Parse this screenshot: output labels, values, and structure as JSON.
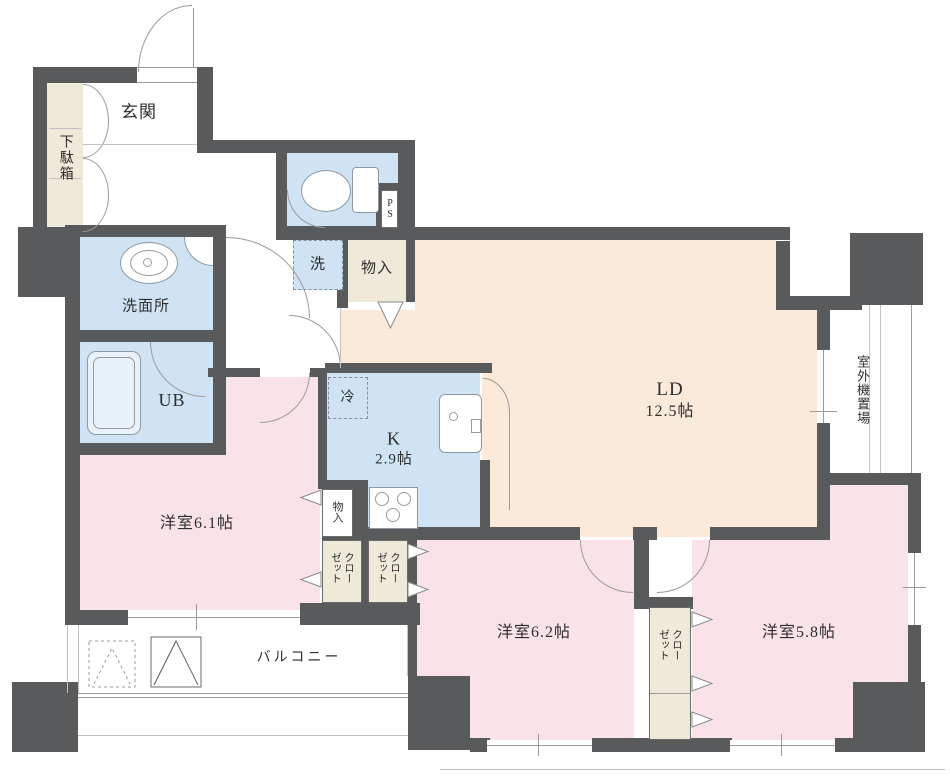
{
  "rooms": {
    "genkan": {
      "name": "玄関"
    },
    "getabako": {
      "name": "下駄箱"
    },
    "ps": {
      "name": "PS"
    },
    "washer": {
      "name": "洗"
    },
    "monoire_hall": {
      "name": "物入"
    },
    "washroom": {
      "name": "洗面所"
    },
    "unit_bath": {
      "name": "UB"
    },
    "fridge": {
      "name": "冷"
    },
    "kitchen": {
      "name": "K",
      "size": "2.9帖"
    },
    "living_dining": {
      "name": "LD",
      "size": "12.5帖"
    },
    "outdoor_unit": {
      "name": "室外機置場"
    },
    "bedroom_a": {
      "name": "洋室6.1帖"
    },
    "monoire_bedroom": {
      "name": "物入"
    },
    "closet_a": {
      "name": "クローゼット"
    },
    "closet_b": {
      "name": "クローゼット"
    },
    "closet_c": {
      "name": "クローゼット"
    },
    "balcony": {
      "name": "バルコニー"
    },
    "bedroom_b": {
      "name": "洋室6.2帖"
    },
    "bedroom_c": {
      "name": "洋室5.8帖"
    }
  },
  "colors": {
    "wall": "#595a5c",
    "bedroom_fill": "#fae3e8",
    "living_fill": "#fbe9d9",
    "wet_area_fill": "#cfe3f4",
    "storage_fill": "#eee9d8"
  }
}
